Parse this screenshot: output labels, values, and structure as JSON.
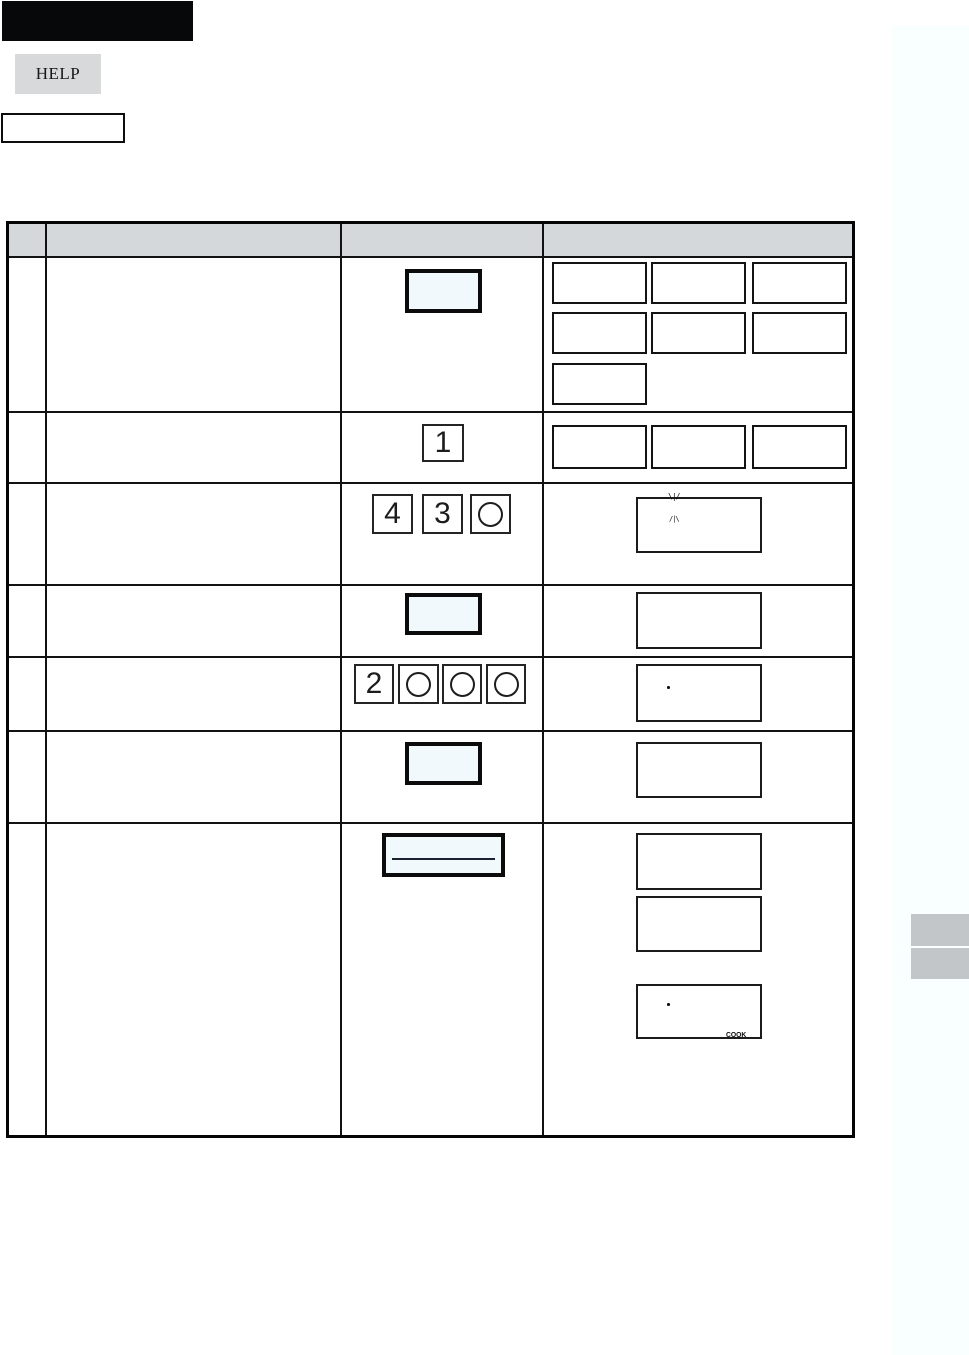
{
  "page": {
    "help_key_label": "HELP",
    "black_banner_text": "",
    "model_box_text": ""
  },
  "colors": {
    "key_fill": "#f1f9fc",
    "header_fill": "#d5d8da",
    "help_key_fill": "#d7d9da",
    "side_tab_fill": "#c3c6c8",
    "margin_tint": "#f9feff"
  },
  "table": {
    "header_labels": [
      "",
      "",
      "",
      ""
    ],
    "steps": [
      {
        "step_no": "",
        "description": "",
        "keys": [
          {
            "shape": "blank-wide-key",
            "label": ""
          }
        ],
        "display_slots": [
          "",
          "",
          "",
          "",
          "",
          "",
          ""
        ]
      },
      {
        "step_no": "",
        "description": "",
        "keys": [
          {
            "shape": "digit",
            "label": "1"
          }
        ],
        "display_slots": [
          "",
          "",
          ""
        ]
      },
      {
        "step_no": "",
        "description": "",
        "keys": [
          {
            "shape": "digit",
            "label": "4"
          },
          {
            "shape": "digit",
            "label": "3"
          },
          {
            "shape": "circle",
            "label": "O"
          }
        ],
        "display": {
          "sparkle_top": "\\|/",
          "sparkle_bottom": "/|\\"
        }
      },
      {
        "step_no": "",
        "description": "",
        "keys": [
          {
            "shape": "blank-wide-key",
            "label": ""
          }
        ],
        "display": {}
      },
      {
        "step_no": "",
        "description": "",
        "keys": [
          {
            "shape": "digit",
            "label": "2"
          },
          {
            "shape": "circle",
            "label": "O"
          },
          {
            "shape": "circle",
            "label": "O"
          },
          {
            "shape": "circle",
            "label": "O"
          }
        ],
        "display": {
          "dot": "·"
        }
      },
      {
        "step_no": "",
        "description": "",
        "keys": [
          {
            "shape": "blank-wide-key",
            "label": ""
          }
        ],
        "display": {}
      },
      {
        "step_no": "",
        "description": "",
        "keys": [
          {
            "shape": "bar-key",
            "label": ""
          }
        ],
        "displays": [
          {},
          {},
          {
            "dot": "·",
            "label": "COOK"
          }
        ]
      }
    ]
  }
}
